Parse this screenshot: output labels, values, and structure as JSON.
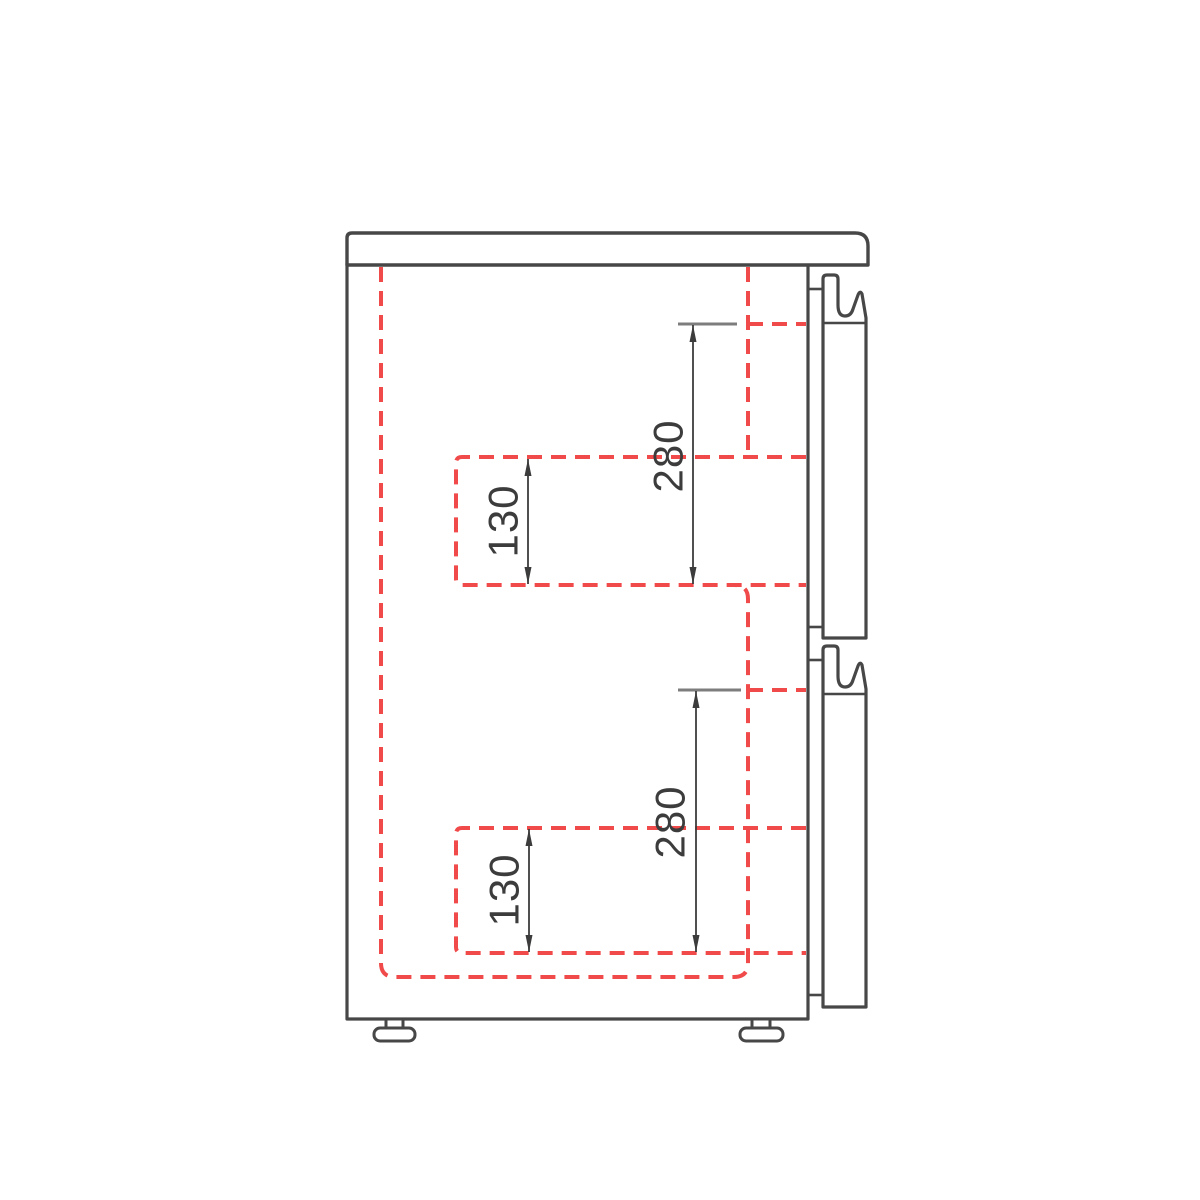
{
  "drawing": {
    "title": "cabinet-side-section-with-two-drawers",
    "dimension_labels": {
      "upper_depth": "280",
      "upper_box": "130",
      "lower_depth": "280",
      "lower_box": "130"
    },
    "colors": {
      "outline": "#474747",
      "dashed": "#f04a4a",
      "dimension": "#3c3c3c",
      "extension": "#7d7d7d",
      "background": "#ffffff"
    }
  }
}
